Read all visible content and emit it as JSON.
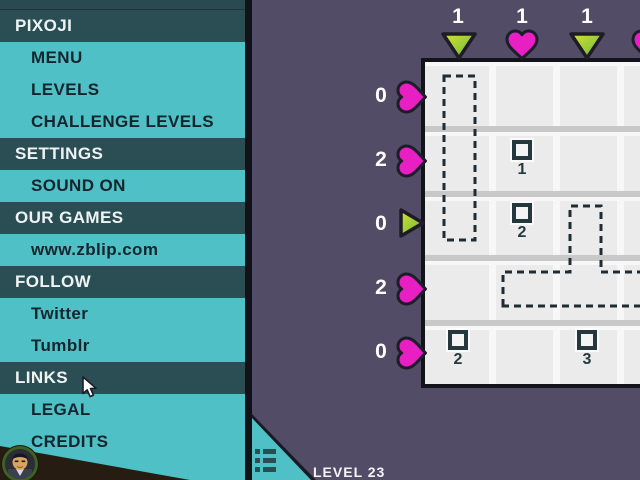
{
  "app": {
    "background": "#524c66"
  },
  "sidebar": {
    "items": [
      {
        "label": "PIXOJI",
        "type": "header"
      },
      {
        "label": "MENU",
        "type": "item"
      },
      {
        "label": "LEVELS",
        "type": "item"
      },
      {
        "label": "CHALLENGE LEVELS",
        "type": "item"
      },
      {
        "label": "SETTINGS",
        "type": "header"
      },
      {
        "label": "SOUND ON",
        "type": "item"
      },
      {
        "label": "OUR GAMES",
        "type": "header"
      },
      {
        "label": "www.zblip.com",
        "type": "item"
      },
      {
        "label": "FOLLOW",
        "type": "header"
      },
      {
        "label": "Twitter",
        "type": "item"
      },
      {
        "label": "Tumblr",
        "type": "item"
      },
      {
        "label": "LINKS",
        "type": "header"
      },
      {
        "label": "LEGAL",
        "type": "item"
      },
      {
        "label": "CREDITS",
        "type": "item"
      }
    ],
    "colors": {
      "panel": "#4fc0c5",
      "header_bg": "#2b4e54",
      "header_text": "#eef4f4",
      "item_text": "#15252d"
    }
  },
  "game": {
    "level_label": "LEVEL 23",
    "column_clues": [
      {
        "count": "1",
        "icon": "triangle-down"
      },
      {
        "count": "1",
        "icon": "heart"
      },
      {
        "count": "1",
        "icon": "triangle-down"
      },
      {
        "count": "",
        "icon": "heart"
      }
    ],
    "row_clues": [
      {
        "count": "0",
        "icon": "heart"
      },
      {
        "count": "2",
        "icon": "heart"
      },
      {
        "count": "0",
        "icon": "triangle-right"
      },
      {
        "count": "2",
        "icon": "heart"
      },
      {
        "count": "0",
        "icon": "heart"
      }
    ],
    "cell_clues": [
      {
        "count": "1"
      },
      {
        "count": "2"
      },
      {
        "count": "2"
      },
      {
        "count": "3"
      }
    ],
    "hint_outline_paths": [
      "M444 76 H475 V240 H444 Z",
      "M503 306 L503 272 L570 272 L570 206 L601 206 L601 272 L664 272 L664 306 Z"
    ],
    "colors": {
      "heart": "#e81fc3",
      "triangle_light": "#d3e32b",
      "triangle_dark": "#6cb644",
      "icon_outline": "#1e1c28",
      "clue_ink": "#24383e",
      "board_cell": "#ebebeb",
      "dash_outline": "#1f2c34"
    }
  }
}
